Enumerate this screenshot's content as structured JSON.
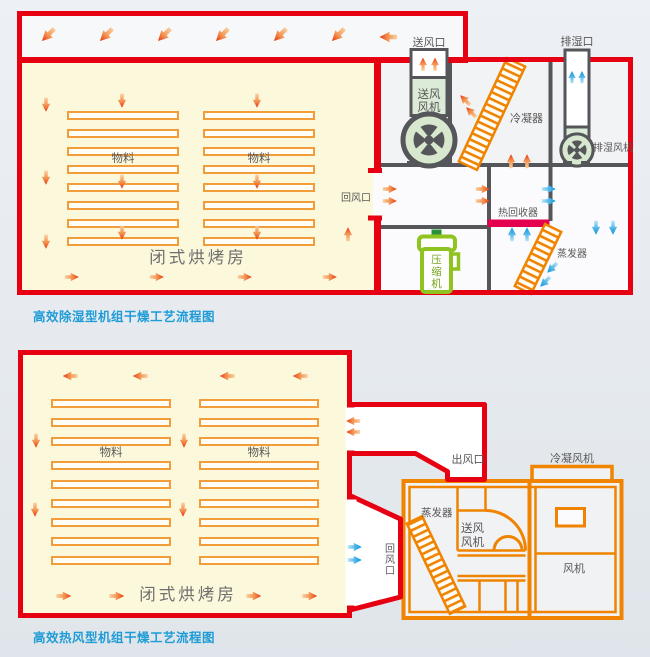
{
  "page": {
    "type": "process-flow-diagrams"
  },
  "colors": {
    "red": "#e60012",
    "orange": "#f08300",
    "tray_orange": "#f29d3a",
    "crimson": "#e5004f",
    "green": "#8fc31f",
    "dark_gray": "#54565a",
    "blue": "#0e96d8",
    "caption_blue": "#1f9cd7",
    "room_yellow": "#fcf8db"
  },
  "diagram1": {
    "caption": "高效除湿型机组干燥工艺流程图",
    "labels": {
      "supply_outlet": "送风口",
      "exhaust_outlet": "排湿口",
      "supply_fan_line1": "送风",
      "supply_fan_line2": "风机",
      "condenser": "冷凝器",
      "exhaust_fan": "排湿风机",
      "return_inlet": "回风口",
      "heat_recovery": "热回收器",
      "compressor": "压缩机",
      "evaporator": "蒸发器",
      "material": "物料",
      "room": "闭式烘烤房"
    }
  },
  "diagram2": {
    "caption": "高效热风型机组干燥工艺流程图",
    "labels": {
      "material": "物料",
      "room": "闭式烘烤房",
      "air_outlet": "出风口",
      "return_inlet": "回风口",
      "condensing_fan": "冷凝风机",
      "evaporator": "蒸发器",
      "supply_fan_line1": "送风",
      "supply_fan_line2": "风机",
      "fan": "风机"
    }
  }
}
